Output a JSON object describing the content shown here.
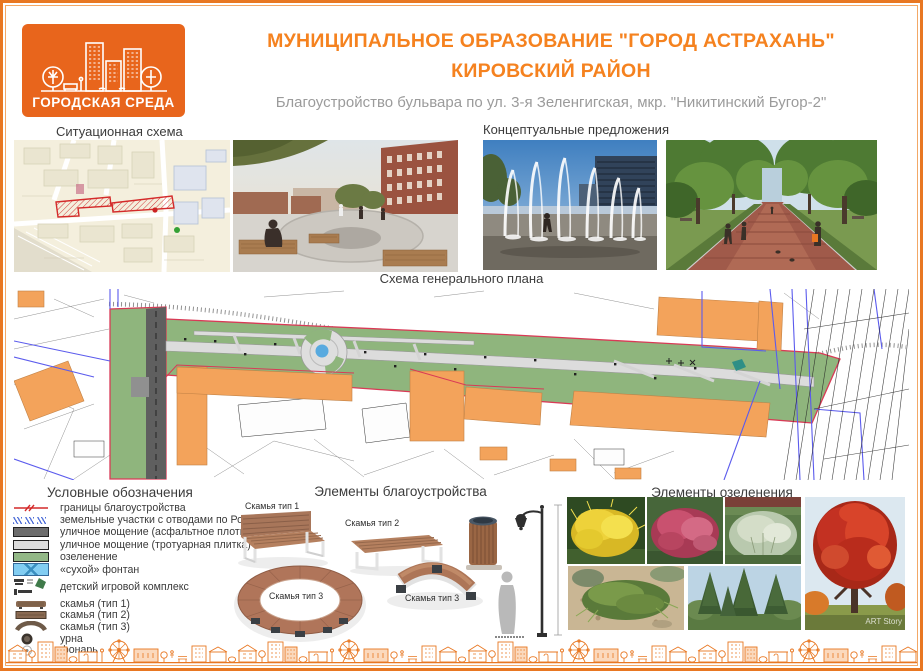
{
  "brand": {
    "logo_text": "ГОРОДСКАЯ СРЕДА"
  },
  "header": {
    "title_line1": "МУНИЦИПАЛЬНОЕ ОБРАЗОВАНИЕ  \"ГОРОД АСТРАХАНЬ\"",
    "title_line2": "КИРОВСКИЙ РАЙОН",
    "subtitle": "Благоустройство бульвара по ул. 3-я Зеленгигская, мкр. \"Никитинский Бугор-2\""
  },
  "sections": {
    "situational_title": "Ситуационная схема",
    "conceptual_title": "Концептуальные предложения",
    "masterplan_title": "Схема генерального плана",
    "legend_title": "Условные обозначения",
    "improvement_title": "Элементы благоустройства",
    "greenery_title": "Элементы озеленения"
  },
  "legend": {
    "items": [
      {
        "label": "границы благоустройства"
      },
      {
        "label": "земельные участки с отводами по Росреестру"
      },
      {
        "label": "уличное мощение (асфальтное плотно)"
      },
      {
        "label": "уличное мощение (тротуарная плитка)"
      },
      {
        "label": "озеленение"
      },
      {
        "label": "«сухой» фонтан"
      },
      {
        "label": "детский игровой комплекс"
      },
      {
        "label": "скамья (тип 1)"
      },
      {
        "label": "скамья (тип 2)"
      },
      {
        "label": "скамья (тип 3)"
      },
      {
        "label": "урна"
      },
      {
        "label": "фонарь"
      }
    ]
  },
  "improvement": {
    "labels": {
      "bench1": "Скамья тип 1",
      "bench2": "Скамья тип 2",
      "bench3_ring": "Скамья тип 3",
      "bench3_arc": "Скамья тип 3"
    }
  },
  "greenery": {
    "watermark": "ART Story"
  },
  "colors": {
    "accent_orange": "#e87722",
    "title_orange": "#f5821f",
    "subtitle_gray": "#9b9b9b",
    "plan_green": "#8fb57d",
    "plan_building_orange": "#f3a35b",
    "boundary_red": "#d93a56",
    "cadastral_blue": "#5b5bed",
    "fountain_blue": "#58aadf"
  }
}
